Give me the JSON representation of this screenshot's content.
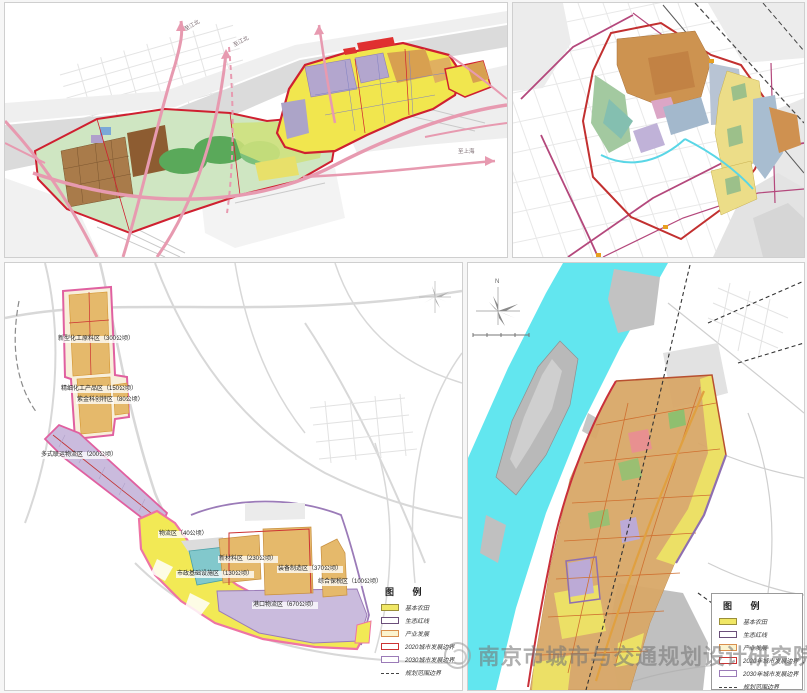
{
  "watermark": {
    "text": "南京市城市与交通规划设计研究院"
  },
  "panel_top_left": {
    "description": "riverside corridor master plan map",
    "road_labels": {
      "to_jiangbei_1": "至江北",
      "to_jiangbei_2": "至江北",
      "to_shanghai": "至上海"
    }
  },
  "panel_top_right": {
    "description": "district land-use plan map"
  },
  "panel_bottom_left": {
    "description": "industry zoning plan map",
    "zones": [
      "新型化工原料区（300公顷）",
      "精细化工产品区（150公顷）",
      "紫金科创特区（80公顷）",
      "多式联运物流区（200公顷）",
      "物流区（40公顷）",
      "新材料区（230公顷）",
      "市政基础设施区（130公顷）",
      "装备制造区（370公顷）",
      "综合保税区（100公顷）",
      "港口物流区（670公顷）"
    ],
    "legend": {
      "title": "图  例",
      "items": [
        {
          "label": "基本农田",
          "swatch_fill": "#f0e765",
          "swatch_border": "#9a8f3a"
        },
        {
          "label": "生态红线",
          "swatch_fill": "#ffffff",
          "swatch_border": "#6b4f7a"
        },
        {
          "label": "产业发展",
          "swatch_fill": "#fbf3cf",
          "swatch_border": "#d98f4e"
        },
        {
          "label": "2020城市发展边界",
          "swatch_fill": "#ffffff",
          "swatch_border": "#cc3333"
        },
        {
          "label": "2030城市发展边界",
          "swatch_fill": "#ffffff",
          "swatch_border": "#9b7bb8"
        },
        {
          "label": "规划范围边界",
          "swatch_style": "dashed-line"
        }
      ]
    }
  },
  "panel_bottom_right": {
    "description": "riverside development boundary map",
    "compass_label": "N",
    "legend": {
      "title": "图  例",
      "items": [
        {
          "label": "基本农田",
          "swatch_fill": "#f0e765",
          "swatch_border": "#9a8f3a"
        },
        {
          "label": "生态红线",
          "swatch_fill": "#ffffff",
          "swatch_border": "#6b4f7a"
        },
        {
          "label": "产业发展",
          "swatch_fill": "#fbf3cf",
          "swatch_border": "#d98f4e"
        },
        {
          "label": "2020年城市发展边界",
          "swatch_fill": "#ffffff",
          "swatch_border": "#cc3333"
        },
        {
          "label": "2030年城市发展边界",
          "swatch_fill": "#ffffff",
          "swatch_border": "#9b7bb8"
        },
        {
          "label": "规划范围边界",
          "swatch_style": "dashed-line"
        }
      ]
    }
  },
  "colors": {
    "river_gray": "#dbdbdb",
    "river_cyan": "#62e6ef",
    "road_pink": "#e79ab0",
    "boundary_red": "#c9303a",
    "boundary_pink": "#ee74a4",
    "boundary_purple": "#9b7bb8",
    "farmland_yellow": "#f2e955",
    "industry_tan": "#e5b96b",
    "logistics_purple": "#cabbdd",
    "teal_zone": "#82c8cc",
    "orange_zone": "#cd9350",
    "brown_zone": "#8d5c31",
    "park_green": "#5aa95a"
  }
}
